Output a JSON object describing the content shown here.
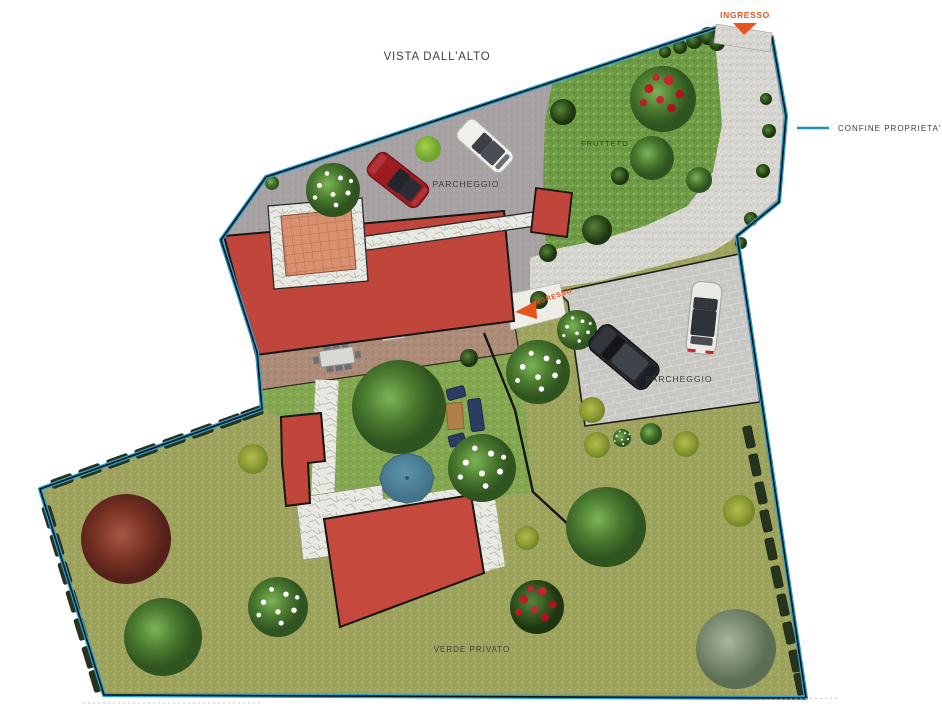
{
  "title": "VISTA DALL'ALTO",
  "legend": {
    "label": "CONFINE PROPRIETA'",
    "line_color": "#1f8fbe"
  },
  "labels": {
    "entrance_top": "INGRESSO",
    "entrance_mid": "INGRESSO",
    "orchard": "FRUTTETO",
    "parking_upper": "PARCHEGGIO",
    "parking_right": "PARCHEGGIO",
    "private_green": "VERDE PRIVATO"
  },
  "colors": {
    "boundary": "#2aa0cf",
    "arrow": "#e6541f",
    "label_text": "#3b3b3b",
    "roof": "#c0453a",
    "pool": "#4e87a0",
    "lawn": "#9ea45e",
    "orchard_grass": "#6e9a45",
    "garden_grass": "#84a751",
    "parking_upper_surface": "#a8a2a5",
    "parking_right_pavers": "#c8c7c3",
    "road_gravel": "#d8d6d1",
    "flagstone": "#e9e9e4",
    "terrace": "#ad8b79",
    "patio_terracotta": "#d8906f"
  }
}
